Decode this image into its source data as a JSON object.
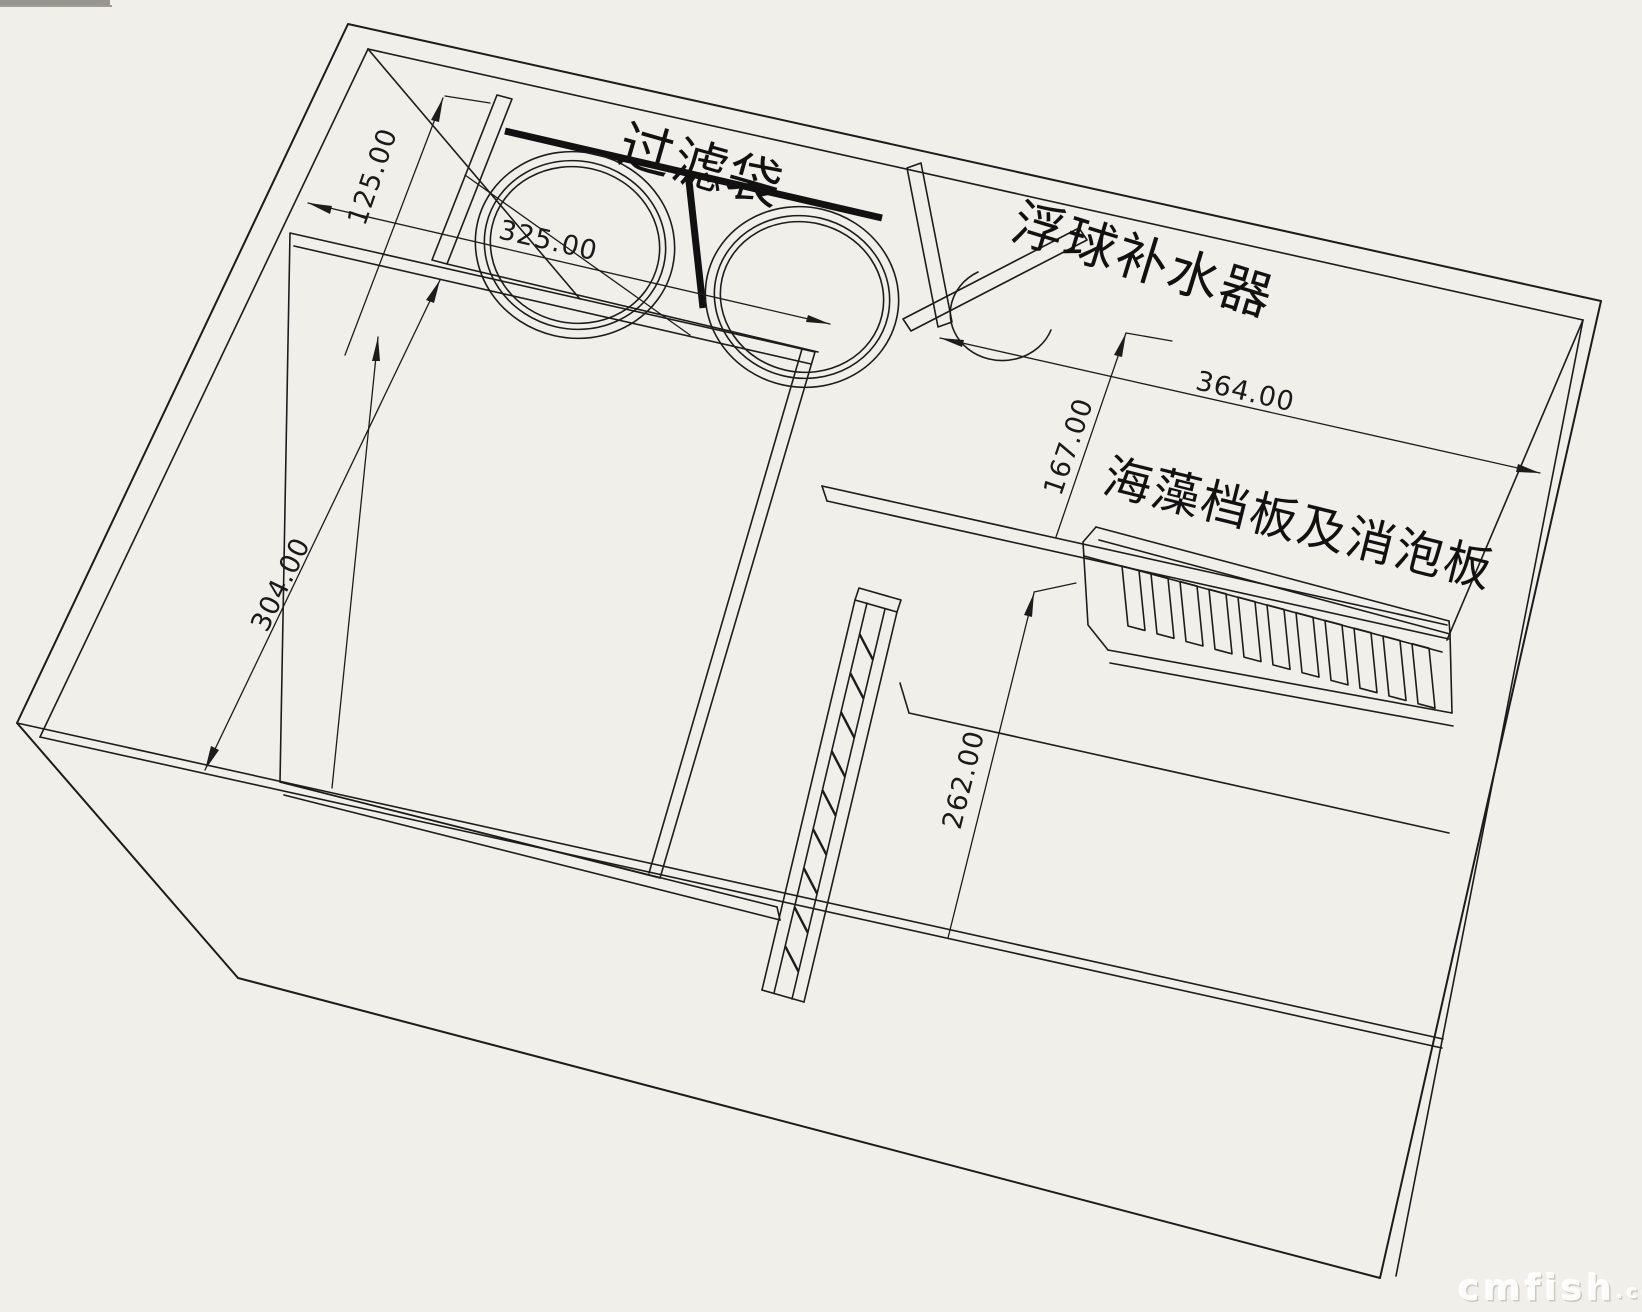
{
  "drawing": {
    "labels": {
      "filter_bag": "过滤袋",
      "float_refill": "浮球补水器",
      "algae_baffle": "海藻档板及消泡板"
    },
    "dimensions": {
      "d125": "125.00",
      "d325": "325.00",
      "d304": "304.00",
      "d364": "364.00",
      "d167": "167.00",
      "d262": "262.00"
    },
    "watermark": {
      "brand": "cmfish",
      "suffix": ".com"
    },
    "colors": {
      "paper": "#f1f0ea",
      "ink": "#1c1c1c"
    }
  }
}
